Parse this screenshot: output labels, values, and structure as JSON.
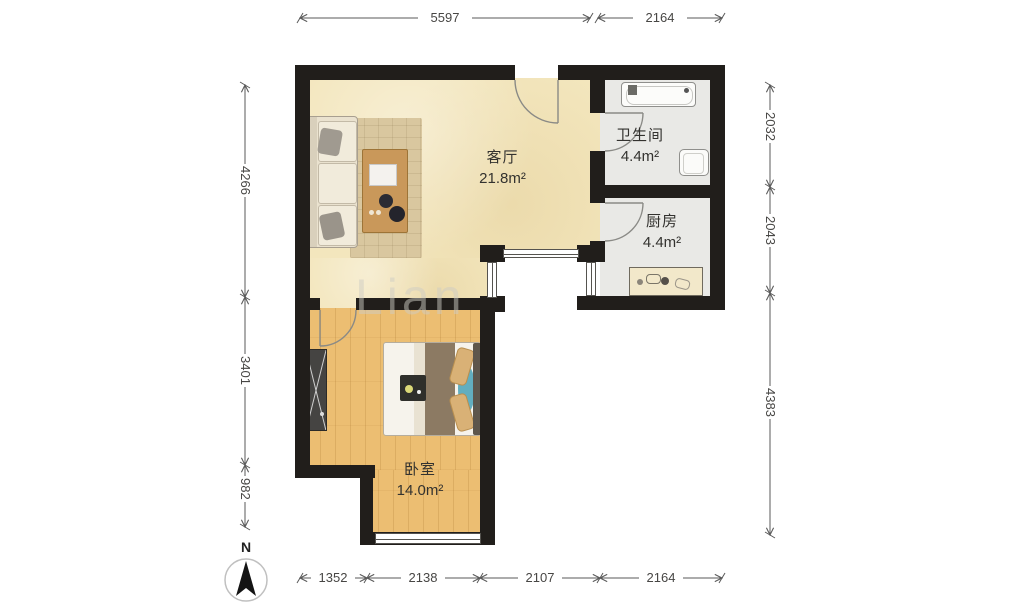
{
  "rooms": {
    "living": {
      "name": "客厅",
      "area": "21.8m²"
    },
    "bathroom": {
      "name": "卫生间",
      "area": "4.4m²"
    },
    "kitchen": {
      "name": "厨房",
      "area": "4.4m²"
    },
    "bedroom": {
      "name": "卧室",
      "area": "14.0m²"
    }
  },
  "dimensions": {
    "top": [
      "5597",
      "2164"
    ],
    "bottom": [
      "1352",
      "2138",
      "2107",
      "2164"
    ],
    "left": [
      "4266",
      "3401",
      "982"
    ],
    "right": [
      "2032",
      "2043",
      "4383"
    ]
  },
  "compass": {
    "label": "N"
  },
  "watermark": "Lian",
  "colors": {
    "wall": "#211e1b",
    "living_floor": "#f3e6bd",
    "bedroom_floor": "#ecbe72",
    "tile_floor": "#e9e9e6",
    "dimension_text": "#474644",
    "room_text": "#33322f"
  }
}
